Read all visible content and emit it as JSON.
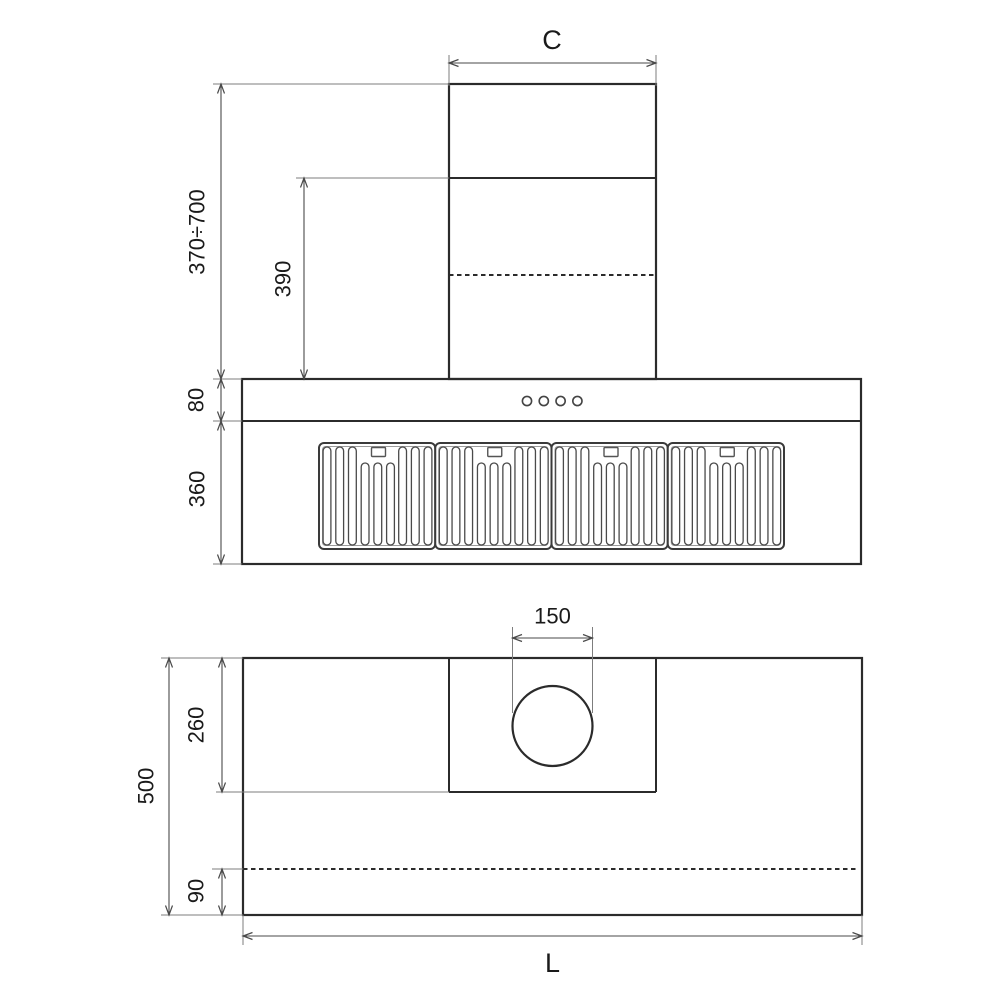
{
  "drawing_title": "range-hood-dimension-drawing",
  "labels": {
    "chimney_width": "C",
    "height_range": "370÷700",
    "chimney_visible_height": "390",
    "control_band_height": "80",
    "body_height": "360",
    "duct_hole_diameter": "150",
    "body_depth": "500",
    "chimney_depth": "260",
    "rear_clearance": "90",
    "body_width": "L"
  },
  "front_view": {
    "button_count": 4,
    "filter_panel_count": 4,
    "full_slots_per_panel": 6,
    "short_slots_per_panel": 3
  },
  "colors": {
    "background": "#ffffff",
    "object_line": "#2b2b2b",
    "dimension_line": "#4a4a4a",
    "extension_line": "#7d7d7d",
    "label_text": "#1a1a1a"
  }
}
